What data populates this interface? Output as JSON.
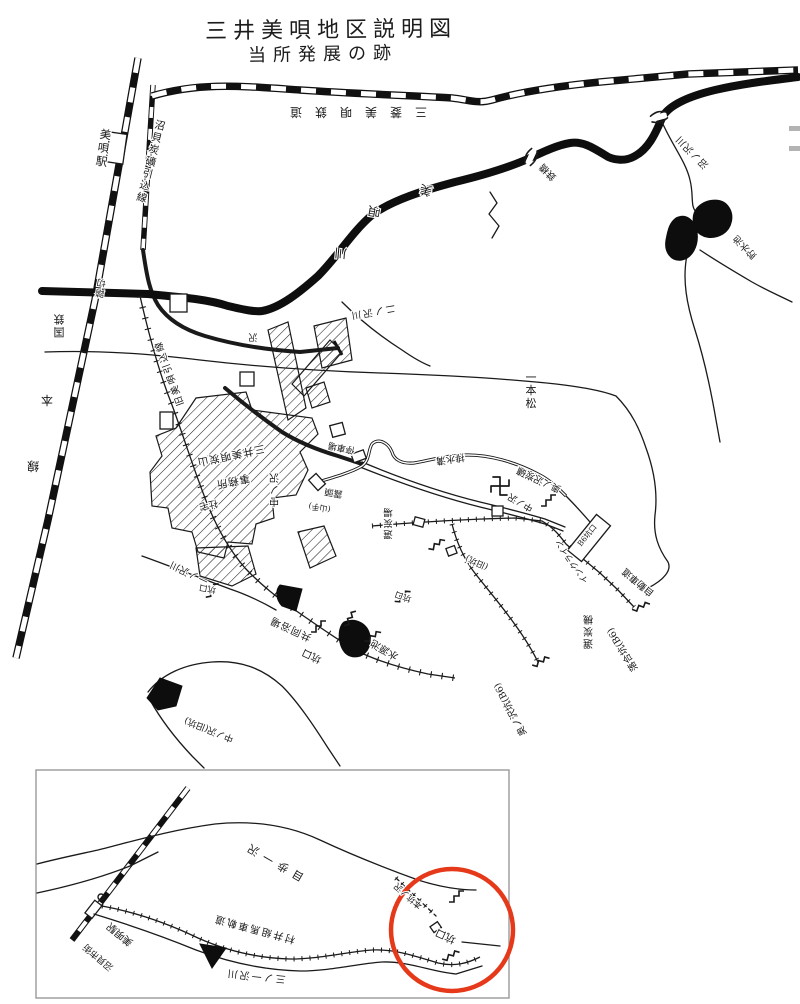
{
  "page": {
    "background": "#ffffff",
    "ink": "#1a1a1a",
    "annotation_red": "#e5391a"
  },
  "header": {
    "title": "三井美唄地区説明図",
    "subtitle": "当所発展の跡"
  },
  "main_map": {
    "labels": [
      {
        "name": "station-label",
        "text": "美唄駅",
        "x": 103,
        "y": 152,
        "rot": 8,
        "fs": 11.5,
        "v": true
      },
      {
        "name": "siding-line-label",
        "text": "沼貝炭礦引込線",
        "x": 150,
        "y": 165,
        "rot": 14,
        "fs": 10.5,
        "v": true
      },
      {
        "name": "mitsubishi-railway-label",
        "text": "三菱美唄鉄道",
        "x": 352,
        "y": 108,
        "rot": 180,
        "fs": 12,
        "ls": 13
      },
      {
        "name": "river-char-1",
        "text": "美",
        "x": 427,
        "y": 186,
        "rot": 195,
        "fs": 12.5
      },
      {
        "name": "river-char-2",
        "text": "唄",
        "x": 375,
        "y": 207,
        "rot": 190,
        "fs": 12.5
      },
      {
        "name": "river-char-3",
        "text": "川",
        "x": 341,
        "y": 249,
        "rot": 185,
        "fs": 12.5
      },
      {
        "name": "bridge-label",
        "text": "鉄橋",
        "x": 550,
        "y": 170,
        "rot": 225,
        "fs": 9.5
      },
      {
        "name": "numanosawa-stream-label",
        "text": "沼ノ沢川",
        "x": 694,
        "y": 150,
        "rot": 225,
        "fs": 9.5,
        "ls": 1
      },
      {
        "name": "reservoir-label",
        "text": "貯水池",
        "x": 747,
        "y": 245,
        "rot": 225,
        "fs": 9.5
      },
      {
        "name": "jnr-label",
        "text": "国鉄",
        "x": 59,
        "y": 322,
        "rot": 180,
        "fs": 11,
        "v": true
      },
      {
        "name": "jnr-label-hon",
        "text": "本",
        "x": 47,
        "y": 396,
        "rot": 180,
        "fs": 12
      },
      {
        "name": "jnr-label-sen",
        "text": "線",
        "x": 33,
        "y": 462,
        "rot": 180,
        "fs": 12
      },
      {
        "name": "crossing-label",
        "text": "踏切",
        "x": 101,
        "y": 285,
        "rot": 188,
        "fs": 9,
        "v": true
      },
      {
        "name": "old-siding-label",
        "text": "旧美唄引込線",
        "x": 172,
        "y": 372,
        "rot": 250,
        "fs": 9.5,
        "ls": 2
      },
      {
        "name": "ninosawa-stream-label",
        "text": "二ノ沢川",
        "x": 372,
        "y": 309,
        "rot": 170,
        "fs": 9.5,
        "ls": 2
      },
      {
        "name": "stream-char",
        "text": "沢",
        "x": 253,
        "y": 334,
        "rot": 180,
        "fs": 9
      },
      {
        "name": "ipponmatsu-label",
        "text": "一本松",
        "x": 531,
        "y": 394,
        "rot": 0,
        "fs": 11,
        "v": true
      },
      {
        "name": "nakanosawa-tram-label",
        "text": "中ノ沢",
        "x": 274,
        "y": 486,
        "rot": 180,
        "fs": 10,
        "v": true
      },
      {
        "name": "office-label-1",
        "text": "三井美唄炭山",
        "x": 230,
        "y": 452,
        "rot": 168,
        "fs": 10.5,
        "ls": 1
      },
      {
        "name": "office-label-2",
        "text": "事務所",
        "x": 232,
        "y": 478,
        "rot": 168,
        "fs": 10.5,
        "ls": 1
      },
      {
        "name": "housing-label",
        "text": "社宅",
        "x": 208,
        "y": 502,
        "rot": 168,
        "fs": 9.5
      },
      {
        "name": "outcrop-label",
        "text": "露頭",
        "x": 334,
        "y": 490,
        "rot": 190,
        "fs": 9
      },
      {
        "name": "yamate-label",
        "text": "(山手)",
        "x": 320,
        "y": 505,
        "rot": 190,
        "fs": 8
      },
      {
        "name": "teishajo-label",
        "text": "停車場",
        "x": 342,
        "y": 445,
        "rot": 192,
        "fs": 9
      },
      {
        "name": "drainage-label",
        "text": "排水溝",
        "x": 450,
        "y": 456,
        "rot": 172,
        "fs": 9.5
      },
      {
        "name": "okunosawa-mine-label",
        "text": "奥ノ沢炭礦",
        "x": 540,
        "y": 477,
        "rot": 205,
        "fs": 9.5
      },
      {
        "name": "temple-stream-label",
        "text": "中ノ沢",
        "x": 522,
        "y": 500,
        "rot": 210,
        "fs": 9
      },
      {
        "name": "b6-box-label",
        "text": "B6坑口",
        "x": 589,
        "y": 537,
        "rot": -51,
        "fs": 7.5
      },
      {
        "name": "incline-label",
        "text": "インクライン",
        "x": 574,
        "y": 560,
        "rot": 235,
        "fs": 8.5
      },
      {
        "name": "road-label",
        "text": "自動車道",
        "x": 640,
        "y": 580,
        "rot": 220,
        "fs": 9.5
      },
      {
        "name": "coal-plant-label",
        "text": "選炭機",
        "x": 588,
        "y": 628,
        "rot": 180,
        "fs": 10,
        "v": true
      },
      {
        "name": "ochiai-mine-label",
        "text": "落合坑(B6)",
        "x": 625,
        "y": 648,
        "rot": 238,
        "fs": 9.5
      },
      {
        "name": "okusawa-mine-label",
        "text": "奥ノ沢坑(B6)",
        "x": 513,
        "y": 708,
        "rot": 242,
        "fs": 9.5
      },
      {
        "name": "pithead-label-1",
        "text": "坑口",
        "x": 313,
        "y": 653,
        "rot": 205,
        "fs": 10
      },
      {
        "name": "pithead-label-2",
        "text": "坑口",
        "x": 208,
        "y": 586,
        "rot": 190,
        "fs": 8.5
      },
      {
        "name": "pithead-label-3",
        "text": "坑口",
        "x": 404,
        "y": 594,
        "rot": 200,
        "fs": 8.5
      },
      {
        "name": "bathhouse-label",
        "text": "共同浴場",
        "x": 292,
        "y": 626,
        "rot": 205,
        "fs": 10,
        "ls": 1
      },
      {
        "name": "watersource-label",
        "text": "水源池",
        "x": 386,
        "y": 647,
        "rot": 210,
        "fs": 10
      },
      {
        "name": "ichinosawa-stream-label",
        "text": "一ノ沢川",
        "x": 190,
        "y": 570,
        "rot": 205,
        "fs": 9.5,
        "ls": 1
      },
      {
        "name": "old-pit-label",
        "text": "中ノ沢(旧坑)",
        "x": 210,
        "y": 727,
        "rot": 202,
        "fs": 9
      },
      {
        "name": "kyuko-label",
        "text": "(旧坑)",
        "x": 478,
        "y": 560,
        "rot": 205,
        "fs": 8.5
      },
      {
        "name": "coal-wash-label",
        "text": "選炭場",
        "x": 388,
        "y": 520,
        "rot": 180,
        "fs": 9.5,
        "v": true
      }
    ]
  },
  "inset_map": {
    "annotation": {
      "shape": "circle",
      "color": "#e5391a"
    },
    "labels": [
      {
        "name": "inset-station-label",
        "text": "美唄駅",
        "x": 122,
        "y": 932,
        "rot": 220,
        "fs": 10
      },
      {
        "name": "inset-town-label",
        "text": "沼貝市街",
        "x": 100,
        "y": 955,
        "rot": 220,
        "fs": 9
      },
      {
        "name": "inset-stream-label",
        "text": "目歩一沢",
        "x": 275,
        "y": 858,
        "rot": 210,
        "fs": 11,
        "ls": 6
      },
      {
        "name": "inset-tramway-label",
        "text": "村井組馬車軌道",
        "x": 255,
        "y": 926,
        "rot": 195,
        "fs": 10,
        "ls": 2
      },
      {
        "name": "inset-river-label",
        "text": "三ノ一沢川",
        "x": 256,
        "y": 973,
        "rot": 186,
        "fs": 10,
        "ls": 2
      },
      {
        "name": "inset-pithead-label",
        "text": "坑口",
        "x": 447,
        "y": 933,
        "rot": 205,
        "fs": 10.5
      },
      {
        "name": "inset-honko-label",
        "text": "本坑ノ沢",
        "x": 410,
        "y": 894,
        "rot": 222,
        "fs": 8.5
      }
    ]
  }
}
